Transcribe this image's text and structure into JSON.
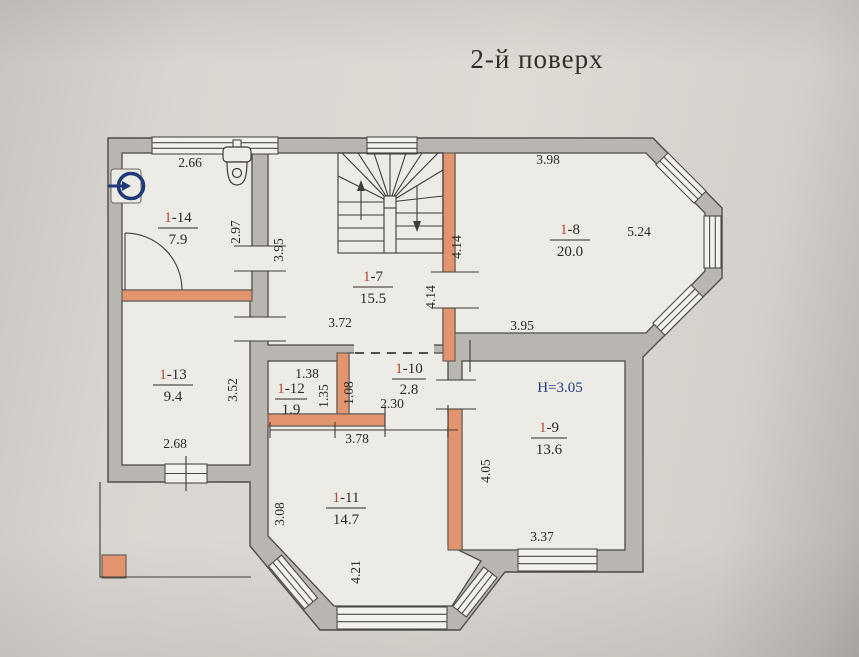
{
  "title": "2-й поверх",
  "plan": {
    "height_note": "H=3.05",
    "rooms": [
      {
        "number": "1-14",
        "area": "7.9"
      },
      {
        "number": "1-7",
        "area": "15.5"
      },
      {
        "number": "1-8",
        "area": "20.0"
      },
      {
        "number": "1-13",
        "area": "9.4"
      },
      {
        "number": "1-12",
        "area": "1.9"
      },
      {
        "number": "1-10",
        "area": "2.8"
      },
      {
        "number": "1-9",
        "area": "13.6"
      },
      {
        "number": "1-11",
        "area": "14.7"
      }
    ],
    "dimensions": {
      "room14_width": "2.66",
      "room14_height": "2.97",
      "hall_height": "3.95",
      "hall_width": "3.72",
      "stair_wall_upper": "4.14",
      "stair_wall_lower": "4.14",
      "room8_width_top": "3.98",
      "room8_side": "5.24",
      "room8_width_bottom": "3.95",
      "room13_height": "3.52",
      "room13_width": "2.68",
      "room12_width": "1.38",
      "room12_height": "1.35",
      "corridor10_height": "1.08",
      "corridor10_width": "2.30",
      "room11_width": "3.78",
      "room11_left_height": "3.08",
      "room11_height": "4.21",
      "room9_height": "4.05",
      "room9_window_width": "3.37"
    },
    "icons": [
      "toilet-icon",
      "boiler-circle-arrow-icon",
      "stairs-icon"
    ],
    "colors": {
      "existing_wall": "#b9b5b0",
      "new_wall_orange": "#e2946e",
      "room_number_red": "#b44a30",
      "height_note_blue": "#24397e",
      "paper": "#d9d5d0"
    }
  }
}
